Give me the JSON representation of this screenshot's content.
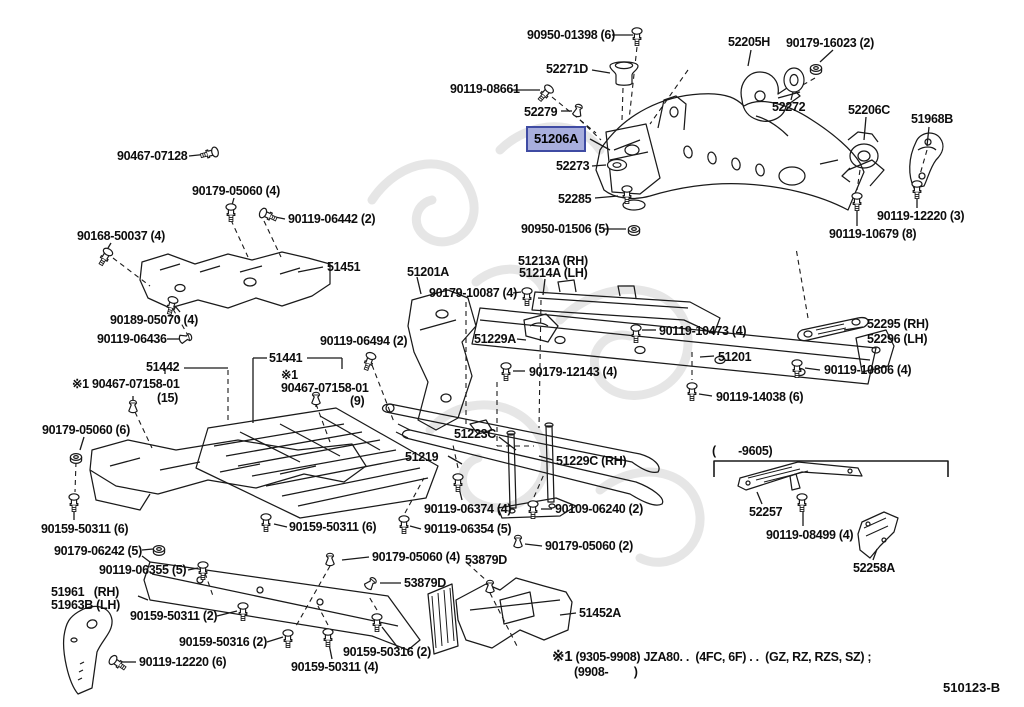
{
  "diagram": {
    "footer_code": "510123-B",
    "colors": {
      "highlight_fill": "#a8aedd",
      "highlight_border": "#3f4ba3",
      "ink": "#1a1a1a",
      "watermark": "#d2d2d2"
    },
    "highlight": {
      "text": "51206A",
      "x": 526,
      "y": 126
    },
    "bracket_note": {
      "text": "(       -9605)",
      "x": 712,
      "y": 444
    },
    "notes": {
      "line1_prefix": "※1",
      "line1": " (9305-9908) JZA80. .  (4FC, 6F) . .  (GZ, RZ, RZS, SZ) ;",
      "line2": "(9908-        )"
    },
    "labels": [
      {
        "text": "90950-01398 (6)",
        "x": 527,
        "y": 29
      },
      {
        "text": "52271D",
        "x": 546,
        "y": 63
      },
      {
        "text": "52205H",
        "x": 728,
        "y": 36
      },
      {
        "text": "90179-16023 (2)",
        "x": 786,
        "y": 37
      },
      {
        "text": "90119-08661",
        "x": 450,
        "y": 83
      },
      {
        "text": "52279",
        "x": 524,
        "y": 106
      },
      {
        "text": "52273",
        "x": 556,
        "y": 160
      },
      {
        "text": "52285",
        "x": 558,
        "y": 193
      },
      {
        "text": "90950-01506 (5)",
        "x": 521,
        "y": 223
      },
      {
        "text": "52272",
        "x": 772,
        "y": 101
      },
      {
        "text": "52206C",
        "x": 848,
        "y": 104
      },
      {
        "text": "51968B",
        "x": 911,
        "y": 113
      },
      {
        "text": "90119-12220 (3)",
        "x": 877,
        "y": 210
      },
      {
        "text": "90119-10679 (8)",
        "x": 829,
        "y": 228
      },
      {
        "text": "90467-07128",
        "x": 117,
        "y": 150
      },
      {
        "text": "90179-05060 (4)",
        "x": 192,
        "y": 185
      },
      {
        "text": "90119-06442 (2)",
        "x": 288,
        "y": 213
      },
      {
        "text": "90168-50037 (4)",
        "x": 77,
        "y": 230
      },
      {
        "text": "51451",
        "x": 327,
        "y": 261
      },
      {
        "text": "90189-05070 (4)",
        "x": 110,
        "y": 314
      },
      {
        "text": "90119-06436",
        "x": 97,
        "y": 333
      },
      {
        "text": "51442",
        "x": 146,
        "y": 361
      },
      {
        "text": "※1 90467-07158-01",
        "x": 72,
        "y": 378
      },
      {
        "text": "(15)",
        "x": 157,
        "y": 392
      },
      {
        "text": "51441",
        "x": 269,
        "y": 352
      },
      {
        "text": "※1",
        "x": 281,
        "y": 369
      },
      {
        "text": "90467-07158-01",
        "x": 281,
        "y": 382
      },
      {
        "text": "(9)",
        "x": 350,
        "y": 395
      },
      {
        "text": "90119-06494 (2)",
        "x": 320,
        "y": 335
      },
      {
        "text": "51201A",
        "x": 407,
        "y": 266
      },
      {
        "text": "90179-10087 (4)",
        "x": 429,
        "y": 287
      },
      {
        "text": "51213A (RH)",
        "x": 518,
        "y": 255
      },
      {
        "text": "51214A (LH)",
        "x": 519,
        "y": 267
      },
      {
        "text": "51229A",
        "x": 474,
        "y": 333
      },
      {
        "text": "90119-10473 (4)",
        "x": 659,
        "y": 325
      },
      {
        "text": "51201",
        "x": 718,
        "y": 351
      },
      {
        "text": "90179-12143 (4)",
        "x": 529,
        "y": 366
      },
      {
        "text": "52295 (RH)",
        "x": 867,
        "y": 318
      },
      {
        "text": "52296 (LH)",
        "x": 867,
        "y": 333
      },
      {
        "text": "90119-10806 (4)",
        "x": 824,
        "y": 364
      },
      {
        "text": "90119-14038 (6)",
        "x": 716,
        "y": 391
      },
      {
        "text": "51223C",
        "x": 454,
        "y": 428
      },
      {
        "text": "51219",
        "x": 405,
        "y": 451
      },
      {
        "text": "51229C (RH)",
        "x": 556,
        "y": 455
      },
      {
        "text": "90179-05060 (6)",
        "x": 42,
        "y": 424
      },
      {
        "text": "90159-50311 (6)",
        "x": 41,
        "y": 523
      },
      {
        "text": "90159-50311 (6)",
        "x": 289,
        "y": 521
      },
      {
        "text": "90119-06374 (4)",
        "x": 424,
        "y": 503
      },
      {
        "text": "90119-06354 (5)",
        "x": 424,
        "y": 523
      },
      {
        "text": "90109-06240 (2)",
        "x": 555,
        "y": 503
      },
      {
        "text": "90179-05060 (2)",
        "x": 545,
        "y": 540
      },
      {
        "text": "90179-05060 (4)",
        "x": 372,
        "y": 551
      },
      {
        "text": "53879D",
        "x": 465,
        "y": 554
      },
      {
        "text": "53879D",
        "x": 404,
        "y": 577
      },
      {
        "text": "90179-06242 (5)",
        "x": 54,
        "y": 545
      },
      {
        "text": "90119-06355 (5)",
        "x": 99,
        "y": 564
      },
      {
        "text": "51961   (RH)",
        "x": 51,
        "y": 586
      },
      {
        "text": "51963B (LH)",
        "x": 51,
        "y": 599
      },
      {
        "text": "90159-50311 (2)",
        "x": 130,
        "y": 610
      },
      {
        "text": "90159-50316 (2)",
        "x": 179,
        "y": 636
      },
      {
        "text": "90119-12220 (6)",
        "x": 139,
        "y": 656
      },
      {
        "text": "90159-50316 (2)",
        "x": 343,
        "y": 646
      },
      {
        "text": "90159-50311 (4)",
        "x": 291,
        "y": 661
      },
      {
        "text": "51452A",
        "x": 579,
        "y": 607
      },
      {
        "text": "52257",
        "x": 749,
        "y": 506
      },
      {
        "text": "90119-08499 (4)",
        "x": 766,
        "y": 529
      },
      {
        "text": "52258A",
        "x": 853,
        "y": 562
      }
    ]
  }
}
